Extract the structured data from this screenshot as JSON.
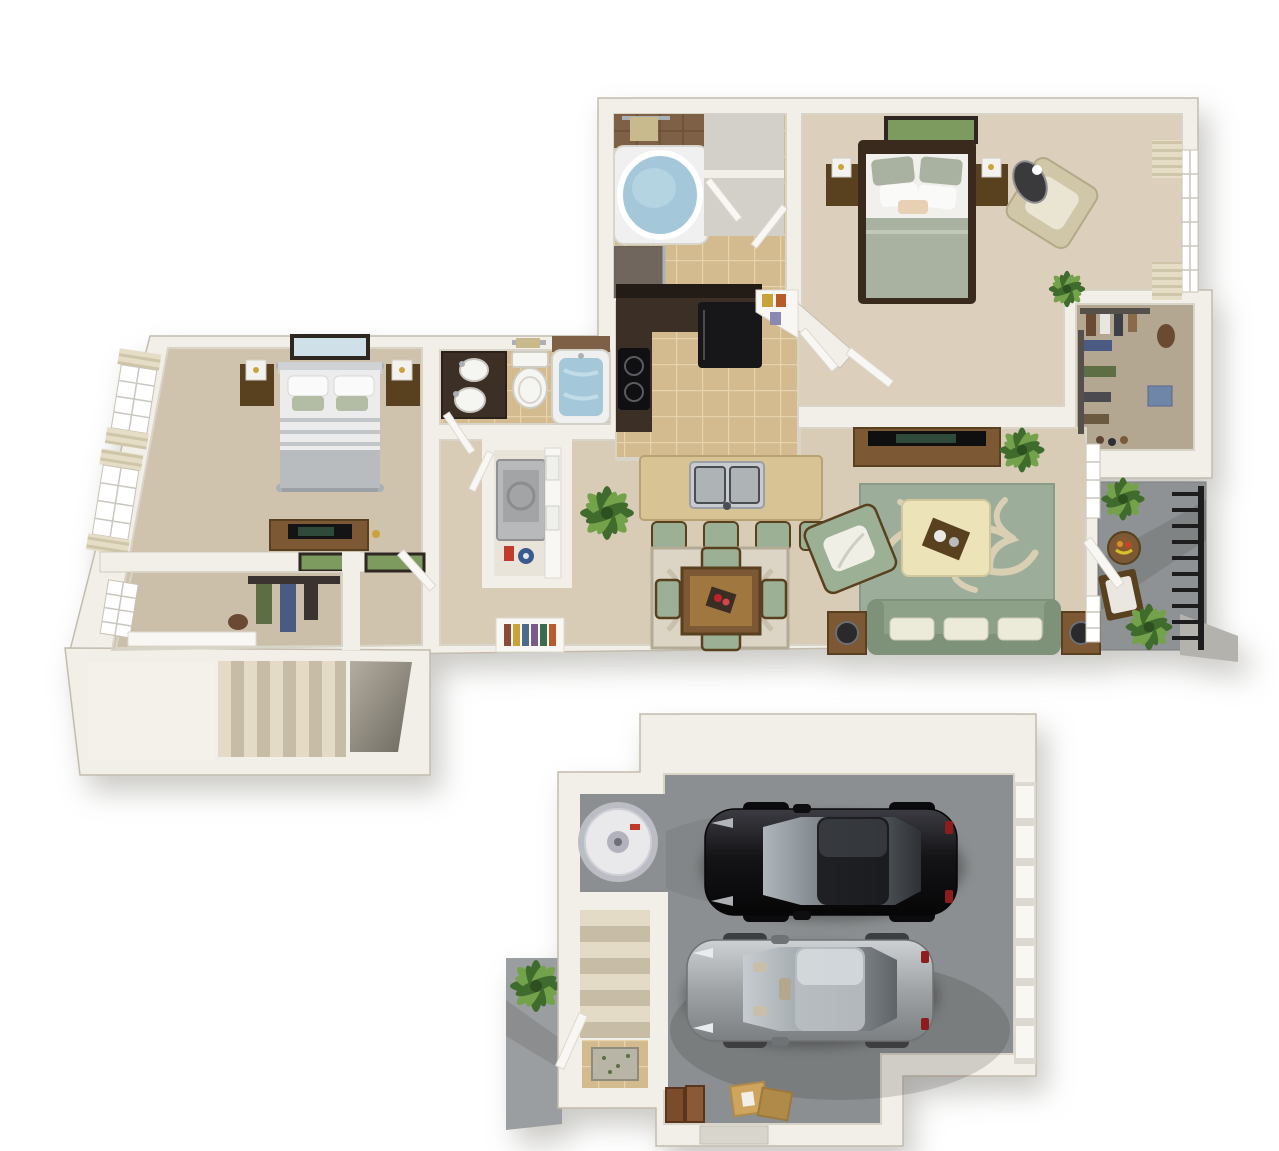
{
  "image": {
    "kind": "3d-rendered-floor-plan",
    "background": "#ffffff",
    "views": [
      "apartment-main-level",
      "two-car-garage-level"
    ]
  },
  "palette": {
    "wall": "#f2efe8",
    "wallShade": "#d9d4c8",
    "wallEdge": "#c8c2b4",
    "outline": "#c3bcae",
    "carpetMain": "#d8ccb7",
    "carpetMaster": "#dccfbb",
    "carpetBed2": "#cfc3ae",
    "carpetCloset": "#cbbfa9",
    "tile": "#d4ba8f",
    "tileGrout": "#e6d2ab",
    "brownTile": "#7d6045",
    "showerTile": "#4b3a2d",
    "cabinetDark": "#3c2f25",
    "counterBlack": "#221b16",
    "fridge": "#17171a",
    "islandTop": "#d8c394",
    "islandEdge": "#b9a173",
    "stainless": "#c8ccd0",
    "stainlessDark": "#4a4e52",
    "woodMid": "#7c5835",
    "woodDark": "#59401f",
    "woodLight": "#a0773f",
    "sofaGreen": "#8da188",
    "sofaGreenDark": "#7e9279",
    "cushionGreen": "#9cb095",
    "pillowWhite": "#ecead9",
    "rugGreen": "#9cad9a",
    "rugCream": "#d9cfb2",
    "ottoman": "#ece3b8",
    "dineRug": "#dcd5c5",
    "dineRugEdge": "#b4ab97",
    "bedWhite": "#f1f0ec",
    "bedSage": "#a9b2a0",
    "frameDark": "#3a2a1e",
    "bed2White": "#ececec",
    "bed2Gray": "#b9bcbe",
    "metal": "#aab0b5",
    "water": "#a4c8da",
    "waterLight": "#c2dce8",
    "tubWhite": "#eff0ef",
    "porcelain": "#f5f5f2",
    "glassTint": "#dfe8ec",
    "slab": "#8f9294",
    "slabDark": "#797b7d",
    "rail": "#1d1d1d",
    "plantDark": "#3f6b2c",
    "plantLight": "#74a24a",
    "stepTan": "#e4dbc6",
    "stepShade": "#c7bda7",
    "stairWell": "#8b867b",
    "garageSlab": "#8c8f91",
    "garageSlabDark": "#717376",
    "carBlack": "#141417",
    "carBlackHi": "#3b3b42",
    "carGray": "#9fa3a6",
    "carGrayHi": "#cdd1d4",
    "glassDark": "#2e3236",
    "glassGray": "#7a8085",
    "glassSheen": "#aeb6bc",
    "cardboard": "#cfa45f",
    "cardboardDark": "#b08a48",
    "suitcase": "#7c4b2a",
    "heater": "#e9e9ec",
    "heaterShade": "#bcbcc4",
    "doorWhite": "#f8f7f4",
    "doorShade": "#ddd9d0",
    "artGreen": "#7d9a5f",
    "artSky": "#cfe0e8",
    "curtain": "#e5ddc6",
    "curtainShade": "#cfc5a9",
    "towel": "#c8ba8c",
    "detergentRed": "#c03a2e",
    "bucketBlue": "#3a5b8f",
    "clothesBlue": "#4a5a82",
    "clothesGreen": "#5d6e45",
    "clothesDark": "#3a3330",
    "leather": "#6b4a33",
    "book1": "#8a4a3a",
    "book2": "#c9a23a",
    "book3": "#4a6b8a",
    "book4": "#7b5a8a",
    "book5": "#3a6b4a",
    "book6": "#b85a2a"
  },
  "apartment": {
    "rooms": [
      {
        "name": "master-bathroom",
        "floor": "tan-tile",
        "fixtures": [
          "garden-tub",
          "walk-in-shower",
          "towel-bar",
          "linen-closet",
          "linen-closet"
        ]
      },
      {
        "name": "master-bedroom",
        "floor": "carpet",
        "furniture": [
          "bed",
          "nightstand",
          "nightstand",
          "table-lamp",
          "table-lamp",
          "wall-art",
          "accent-chair",
          "oval-decor-mirror",
          "window-with-curtains"
        ]
      },
      {
        "name": "walk-in-closet",
        "contents": [
          "hanging-clothes",
          "shoes",
          "storage-box",
          "handbag"
        ]
      },
      {
        "name": "balcony",
        "floor": "concrete",
        "contents": [
          "metal-railing",
          "bistro-table",
          "fruit-bowl",
          "patio-chair",
          "potted-plant",
          "potted-plant"
        ]
      },
      {
        "name": "kitchen",
        "floor": "tan-tile",
        "features": [
          "dark-wood-cabinets",
          "refrigerator",
          "cooktop",
          "corner-pantry-shelves",
          "island-with-double-sink"
        ],
        "bar_stool_count": 4
      },
      {
        "name": "dining-area",
        "furniture": [
          "square-wood-table",
          "area-rug",
          "centerpiece"
        ],
        "chair_count": 4
      },
      {
        "name": "living-room",
        "furniture": [
          "sofa",
          "throw-pillow",
          "throw-pillow",
          "throw-pillow",
          "armchair",
          "ottoman-coffee-table",
          "serving-tray",
          "patterned-rug",
          "tv-console",
          "flat-tv",
          "side-table",
          "side-table",
          "speaker",
          "speaker",
          "potted-plant",
          "french-doors"
        ]
      },
      {
        "name": "hallway",
        "contents": [
          "potted-plant",
          "built-in-bookshelf",
          "built-in-bookshelf"
        ]
      },
      {
        "name": "laundry-closet",
        "contents": [
          "washer-dryer",
          "shelving",
          "basket",
          "basket",
          "detergent",
          "bucket"
        ]
      },
      {
        "name": "bathroom-2",
        "fixtures": [
          "dark-vanity-with-sinks",
          "toilet",
          "soaking-tub",
          "towel-bar"
        ]
      },
      {
        "name": "bedroom-2",
        "floor": "carpet",
        "furniture": [
          "bed",
          "nightstand",
          "nightstand",
          "table-lamp",
          "table-lamp",
          "wall-art",
          "dresser",
          "flat-tv",
          "wall-frames",
          "window-with-curtains",
          "window-with-curtains"
        ]
      },
      {
        "name": "bedroom-2-closet",
        "contents": [
          "window",
          "hanging-clothes",
          "shelf",
          "handbag"
        ]
      },
      {
        "name": "stairwell",
        "contents": [
          "staircase-down",
          "open-stair-well"
        ]
      }
    ]
  },
  "garage": {
    "type": "attached-two-car-garage",
    "car_count": 2,
    "contents": [
      "black-sedan",
      "gray-sedan",
      "water-heater",
      "paneled-garage-door",
      "staircase-up",
      "entry-door",
      "tile-landing-with-rug",
      "suitcases",
      "cardboard-boxes",
      "exterior-walkway",
      "potted-plant",
      "door-stoop"
    ]
  }
}
